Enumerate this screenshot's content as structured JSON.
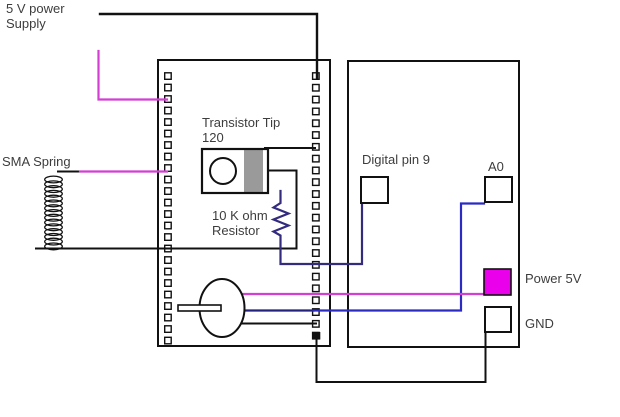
{
  "title": "Hand-drawn circuit wiring diagram: SMA spring actuator with TIP120 transistor, breadboard and Arduino",
  "labels": {
    "power_supply": "5 V power\nSupply",
    "sma_spring": "SMA Spring",
    "transistor": "Transistor Tip\n120",
    "resistor": "10 K ohm\nResistor",
    "digital_pin9": "Digital pin 9",
    "a0": "A0",
    "power_5v": "Power 5V",
    "gnd": "GND"
  },
  "colors": {
    "wire_black": "#111111",
    "wire_magenta": "#D23FD2",
    "wire_blue_resistor": "#332B7E",
    "wire_blue_a0": "#2B2BC4",
    "wire_navy_motor": "#23237E",
    "power_5v_fill": "#EA00EA",
    "transistor_band": "#9A9A9A",
    "text": "#3D3D3D"
  },
  "components": [
    {
      "name": "breadboard",
      "symbol": "rectangle-with-hole-columns"
    },
    {
      "name": "arduino-board",
      "symbol": "plain-rectangle"
    },
    {
      "name": "tip120-transistor",
      "symbol": "rect-with-circle-and-gray-band"
    },
    {
      "name": "10k-resistor",
      "symbol": "zigzag"
    },
    {
      "name": "dc-motor",
      "symbol": "ellipse-with-shaft"
    },
    {
      "name": "sma-spring",
      "symbol": "vertical-coil"
    },
    {
      "name": "digital-pin-9-pad",
      "symbol": "small-square"
    },
    {
      "name": "a0-pad",
      "symbol": "small-square"
    },
    {
      "name": "power-5v-pad",
      "symbol": "filled-magenta-square"
    },
    {
      "name": "gnd-pad",
      "symbol": "small-square"
    }
  ]
}
